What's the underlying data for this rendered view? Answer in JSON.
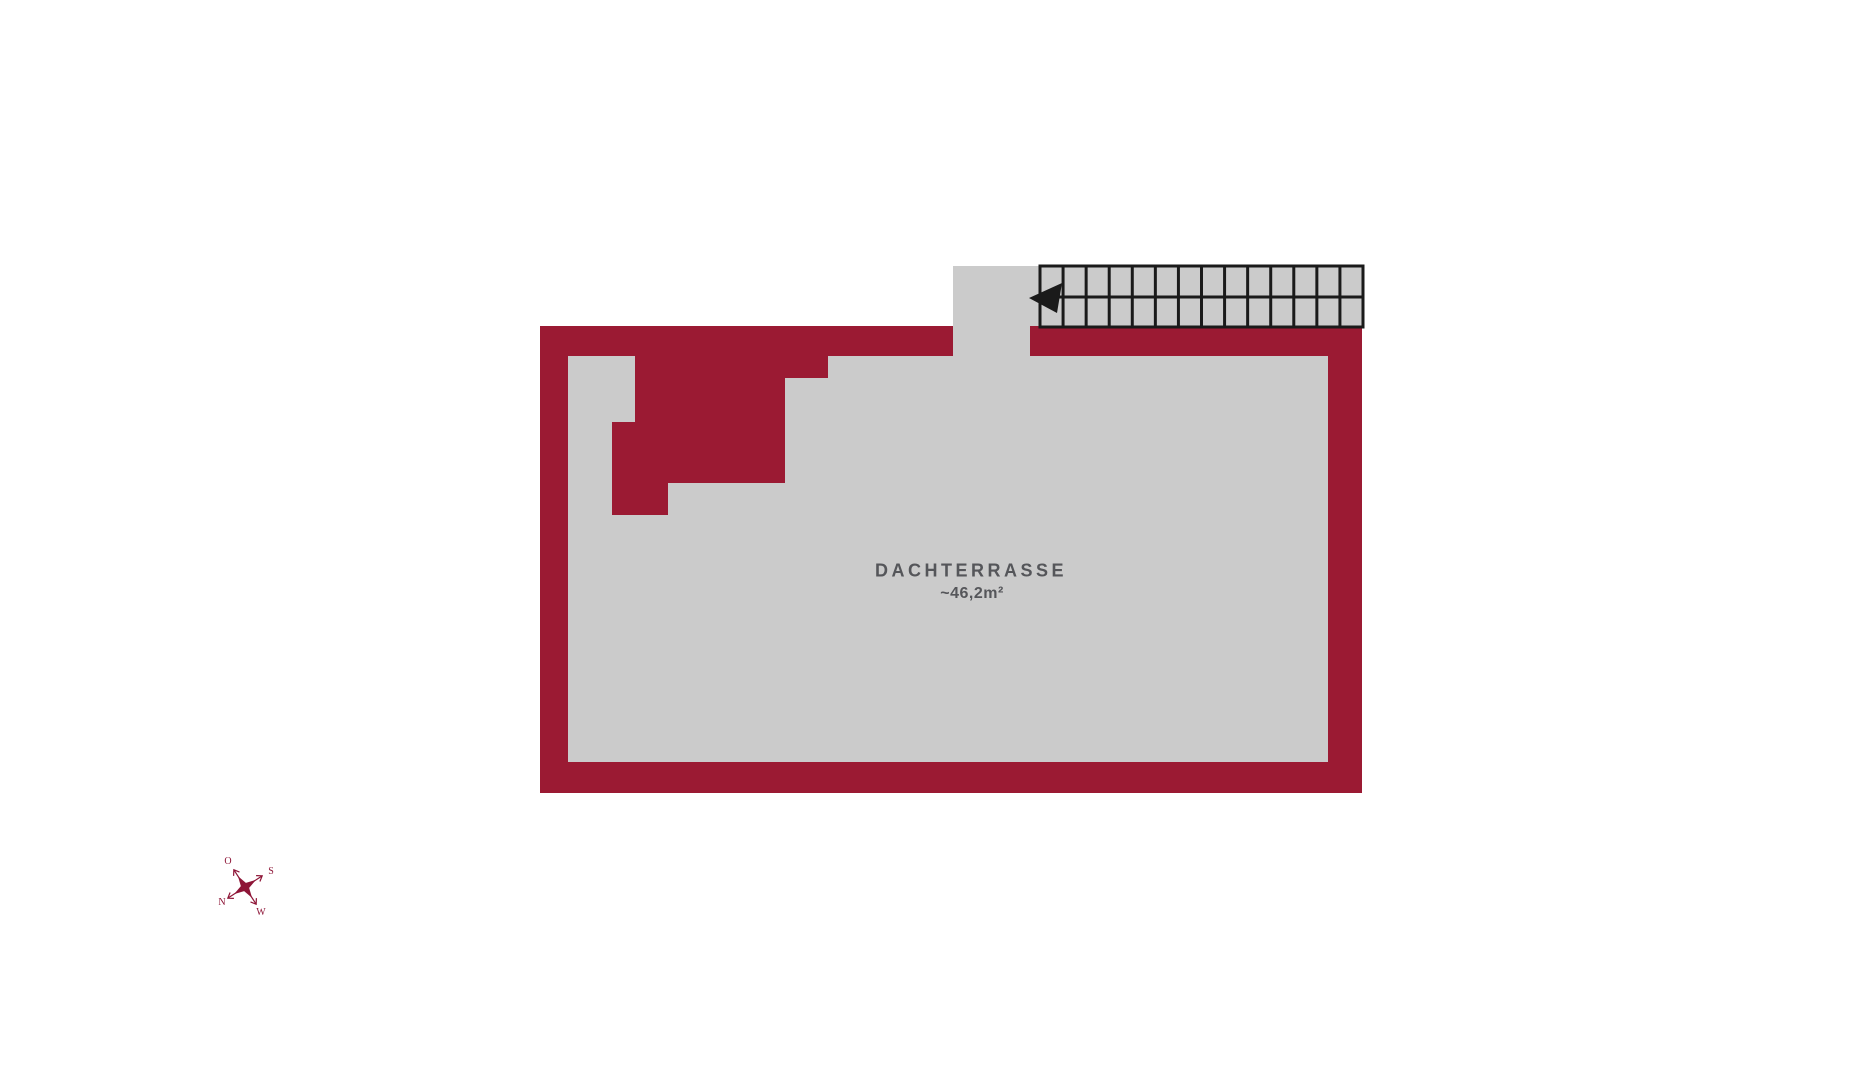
{
  "colors": {
    "bg": "#ffffff",
    "wall": "#9b1a33",
    "floor": "#cbcbcb",
    "line": "#1a1a1a",
    "text": "#55565a",
    "compass": "#8e1537"
  },
  "plan": {
    "room_label": "DACHTERRASSE",
    "room_area": "~46,2m²"
  },
  "stairs": {
    "steps": 14,
    "direction_arrow": "left"
  },
  "compass": {
    "north": "N",
    "east": "O",
    "south": "S",
    "west": "W"
  }
}
